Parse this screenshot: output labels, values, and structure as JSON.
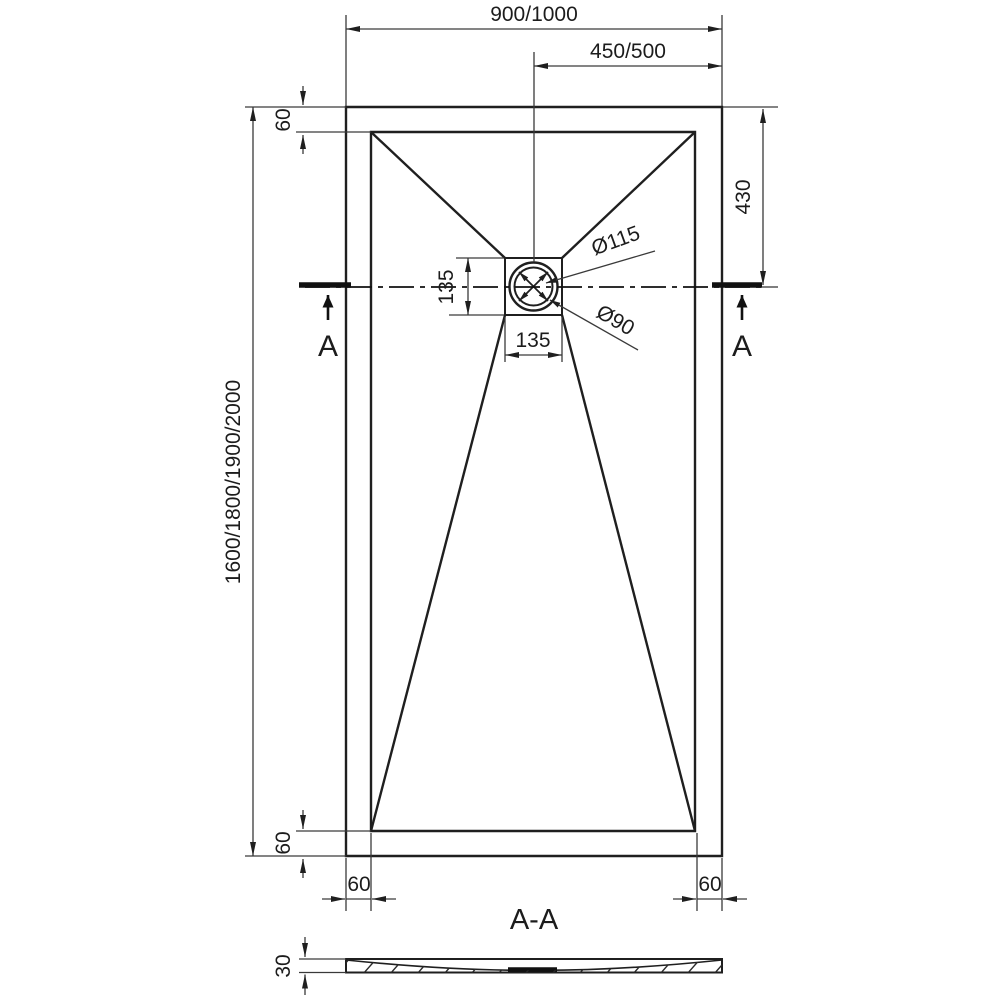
{
  "drawing": {
    "type": "shower tray technical drawing, plan view with section",
    "colors": {
      "line": "#1f1f1f",
      "dimension_line": "#3a3a3a",
      "background": "#ffffff"
    }
  },
  "plan": {
    "dim_overall_width": "900/1000",
    "dim_drain_center_width": "450/500",
    "dim_overall_length": "1600/1800/1900/2000",
    "dim_rim_top": "60",
    "dim_rim_bottom_left_v": "60",
    "dim_rim_bottom_left_h": "60",
    "dim_rim_bottom_right_h": "60",
    "dim_drain_from_top": "430",
    "dim_drain_box_height": "135",
    "dim_drain_box_width": "135",
    "label_drain_outer_diameter": "Ø115",
    "label_drain_inner_diameter": "Ø90",
    "section_marker_left": "A",
    "section_marker_right": "A"
  },
  "section": {
    "title": "A-A",
    "dim_thickness": "30"
  }
}
